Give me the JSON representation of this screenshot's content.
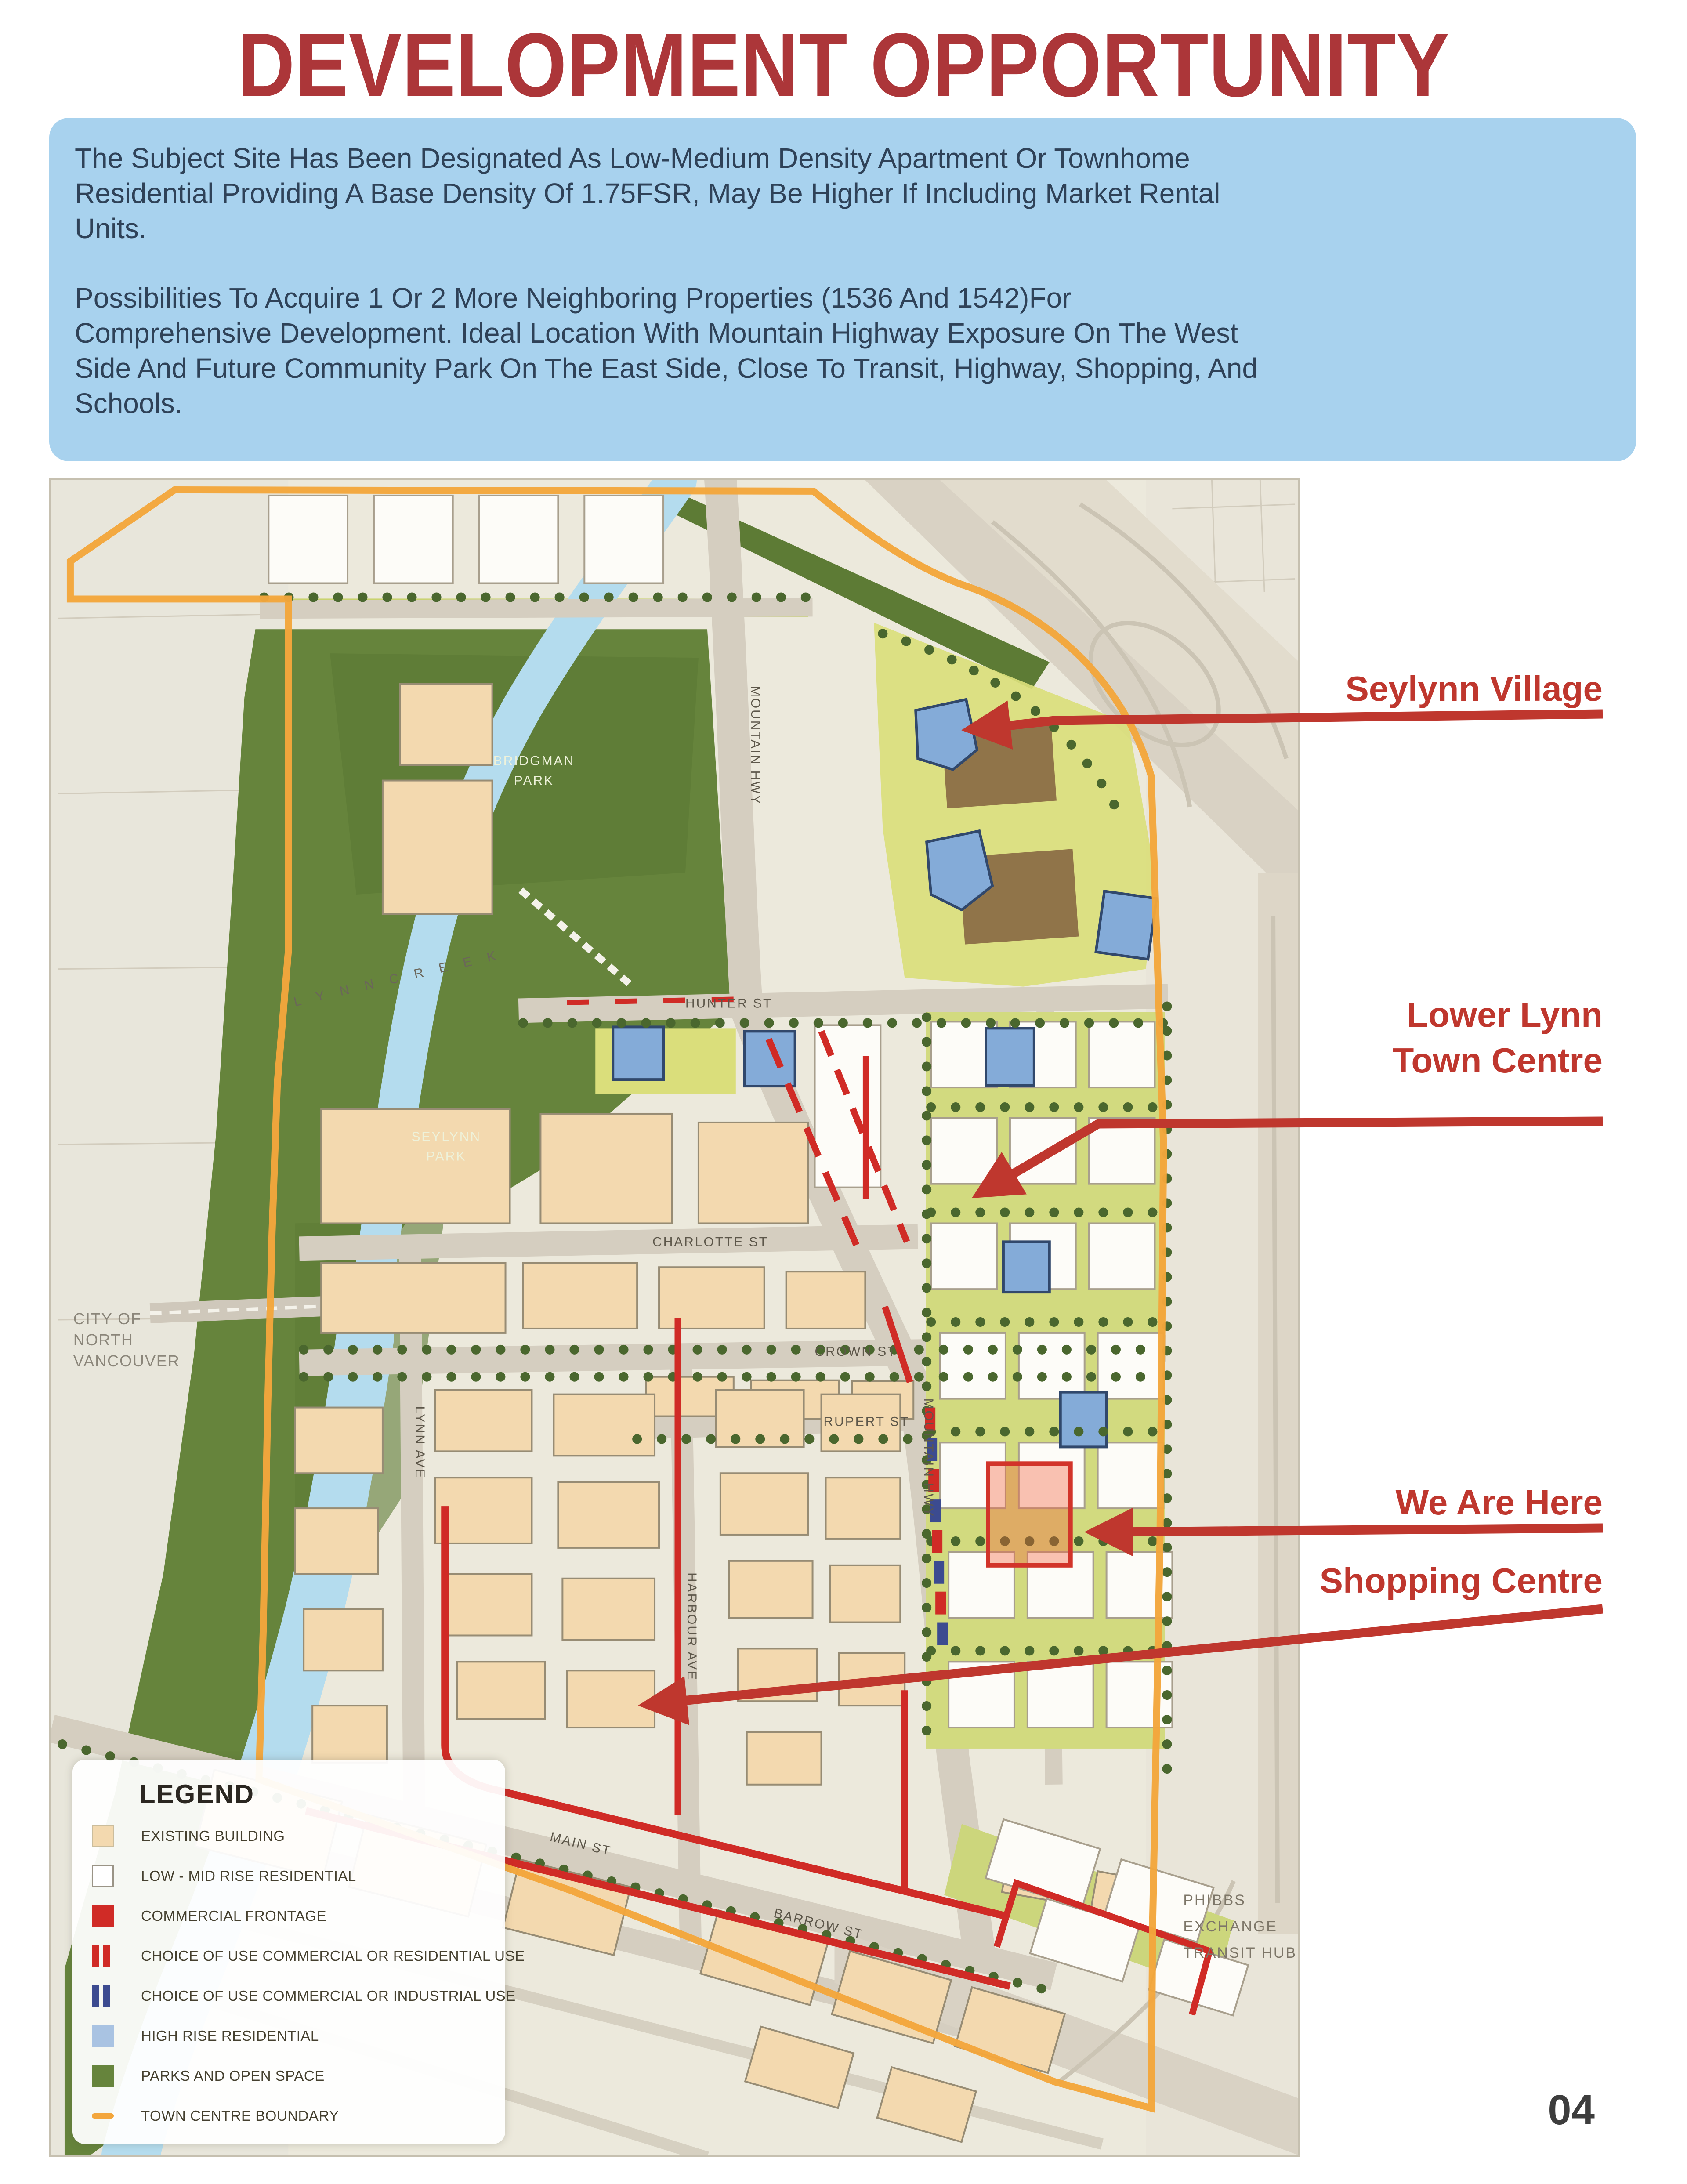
{
  "header": {
    "title": "DEVELOPMENT OPPORTUNITY"
  },
  "intro": {
    "p1": "The Subject Site Has Been Designated As Low-Medium Density Apartment Or Townhome\nResidential Providing A Base Density Of 1.75FSR, May Be Higher If Including Market Rental\nUnits.",
    "p2": "Possibilities To Acquire 1 Or 2 More Neighboring Properties (1536 And 1542)For\nComprehensive Development. Ideal Location With Mountain Highway Exposure On The West\nSide And Future Community Park On The East Side, Close To Transit, Highway, Shopping, And\nSchools."
  },
  "annotations": {
    "seylynn_village": "Seylynn Village",
    "lower_lynn": "Lower Lynn\nTown Centre",
    "we_are_here": "We Are Here",
    "shopping_centre": "Shopping Centre"
  },
  "map_labels": {
    "city_line1": "CITY OF",
    "city_line2": "NORTH",
    "city_line3": "VANCOUVER",
    "bridgman_line1": "BRIDGMAN",
    "bridgman_line2": "PARK",
    "seylynn_line1": "SEYLYNN",
    "seylynn_line2": "PARK",
    "lynn_creek": "L Y N N   C R E E K",
    "mountain_hwy_upper": "MOUNTAIN HWY",
    "mountain_hwy_lower": "MOUNTAIN HWY",
    "hunter_st": "HUNTER ST",
    "charlotte_st": "CHARLOTTE ST",
    "crown_st": "CROWN ST",
    "rupert_st": "RUPERT ST",
    "lynn_ave": "LYNN AVE",
    "harbour_ave": "HARBOUR AVE",
    "main_st": "MAIN ST",
    "barrow_st": "BARROW ST",
    "phibbs_line1": "PHIBBS",
    "phibbs_line2": "EXCHANGE",
    "phibbs_line3": "TRANSIT HUB"
  },
  "legend": {
    "title": "LEGEND",
    "items": [
      {
        "label": "EXISTING BUILDING"
      },
      {
        "label": "LOW - MID RISE RESIDENTIAL"
      },
      {
        "label": "COMMERCIAL FRONTAGE"
      },
      {
        "label": "CHOICE OF USE COMMERCIAL OR RESIDENTIAL USE"
      },
      {
        "label": "CHOICE OF USE COMMERCIAL OR INDUSTRIAL USE"
      },
      {
        "label": "HIGH RISE RESIDENTIAL"
      },
      {
        "label": "PARKS AND OPEN SPACE"
      },
      {
        "label": "TOWN CENTRE BOUNDARY"
      }
    ]
  },
  "page": {
    "number": "04"
  },
  "colors": {
    "title_red": "#ac3639",
    "annotation_red": "#bf372e",
    "intro_bg": "#a8d2ee",
    "intro_text": "#2f4258",
    "boundary_orange": "#f3a63c",
    "park_green": "#66843c",
    "creek_blue": "#b4dcee",
    "existing_tan": "#f3d9af",
    "highrise_blue": "#84abd8",
    "commercial_red": "#d02b26",
    "industrial_blue": "#3c4b90"
  }
}
